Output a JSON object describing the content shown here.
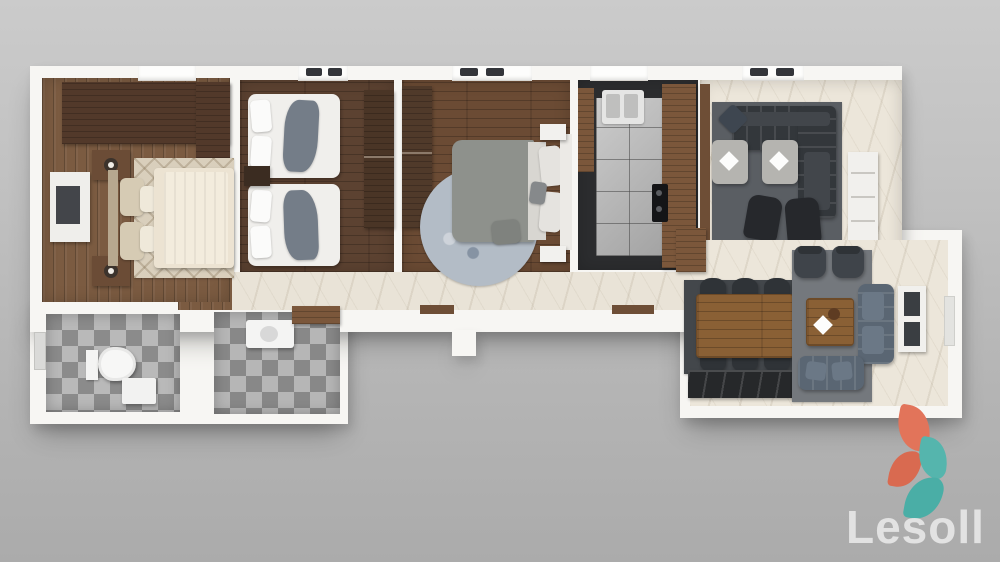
{
  "brand": {
    "name": "Lesoll",
    "logo_orange": "#e2745a",
    "logo_orange_dark": "#d96a50",
    "logo_teal": "#55b5ad",
    "logo_teal_dark": "#4aaea6"
  },
  "scene": {
    "kind": "3d-apartment-floor-plan-top-view",
    "background_top": "#cbcbcb",
    "background_bottom": "#ababab",
    "wall_color": "#f7f6f3"
  },
  "rooms": {
    "master_bedroom": {
      "floor": "#7b5b41",
      "rug": "#d9cfbc",
      "wardrobe": "#52392a",
      "bed": "#ece3d2"
    },
    "kids_bedroom": {
      "floor": "#5c4231",
      "wardrobe": "#4a3526",
      "bed": "#f0efec",
      "throw": "#747d88"
    },
    "second_bedroom": {
      "floor": "#6b4b34",
      "wardrobe": "#503a2a",
      "rug": "#b3bcc6",
      "duvet": "#8e918c"
    },
    "kitchen": {
      "counter": "#2c2d2f",
      "tiles": "#b6b6b6",
      "cabinet_wood": "#7b573b",
      "sink": "#e5e5e4",
      "cooktop": "#141517"
    },
    "living_room": {
      "floor": "#ece6da",
      "rug": "#5a5e63",
      "sofa": "#33373b",
      "ottoman": "#b5b4b0",
      "chair": "#26282c",
      "media_unit": "#f1f0ed"
    },
    "hallway": {
      "floor": "#e9e3d7",
      "threshold": "#6e4e36"
    },
    "bathroom_1": {
      "floor": "#a2a2a2",
      "toilet": "#f7f7f6"
    },
    "bathroom_2": {
      "floor": "#9e9e9e",
      "vanity": "#f4f4f3",
      "counter": "#7b573b"
    },
    "dining_room": {
      "rug": "#43474b",
      "table": "#8a6035",
      "chair": "#2f3337",
      "sideboard": "#26282a",
      "cabinet": "#7b573b"
    },
    "family_room": {
      "rug": "#74787d",
      "sofa": "#5a6673",
      "armchair": "#3f444a",
      "coffee_table": "#8a6035",
      "console": "#f1f0ed"
    }
  }
}
